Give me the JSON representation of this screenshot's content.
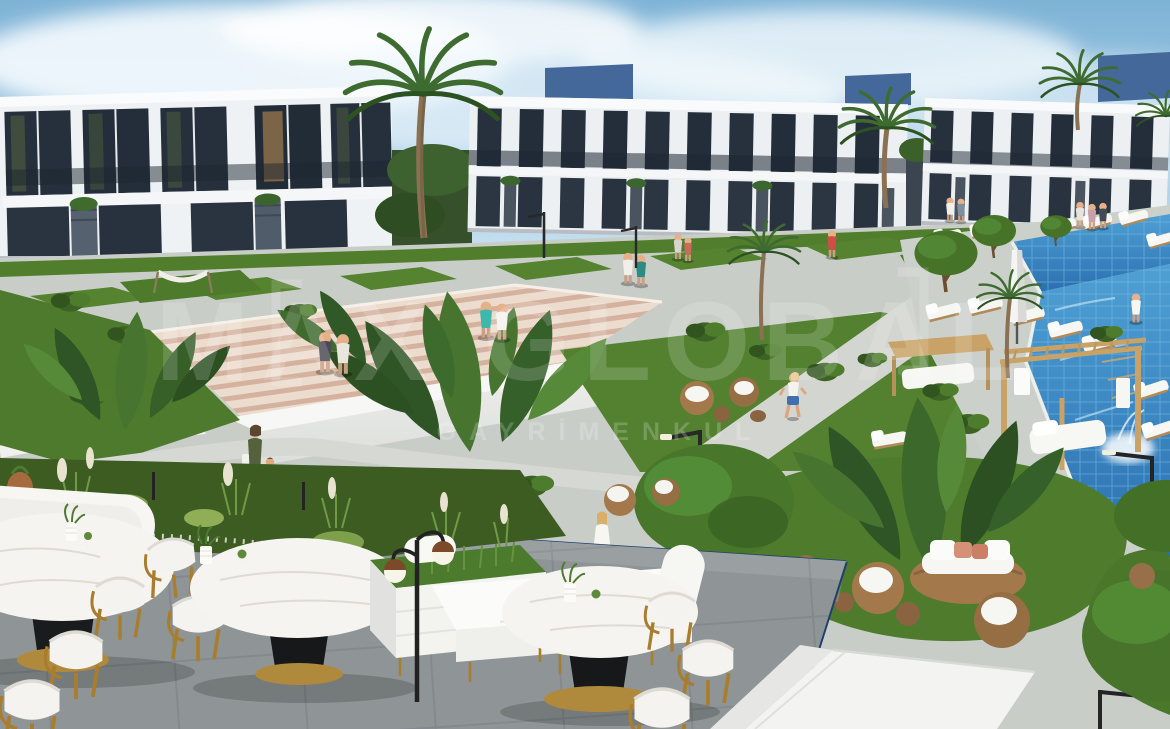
{
  "watermark": {
    "brand": "MAX GLOBAL",
    "subtitle": "GAYRİMENKUL"
  },
  "palette": {
    "sky_top": "#7eb3d6",
    "sky_horizon": "#dff0f8",
    "cloud_white": "#f6fbfe",
    "building_white": "#eff2f4",
    "window_glass": "#26303c",
    "roof_box_blue": "#44689a",
    "lawn_green": "#53822f",
    "bush_dark": "#2e4d1e",
    "palm_green": "#3e6b2f",
    "plaza_gray": "#8f9597",
    "path_light": "#d3d5d0",
    "steps_cream": "#ecdccd",
    "pool_blue": "#2f83c4",
    "pool_light": "#7cc0e2",
    "pergola_tan": "#c8a266",
    "rattan_brown": "#a3794c",
    "marble_white": "#f6f4f1",
    "brass_gold": "#ab8136",
    "railing_navy": "#1e3f6e",
    "cushion_salmon": "#d69077"
  }
}
